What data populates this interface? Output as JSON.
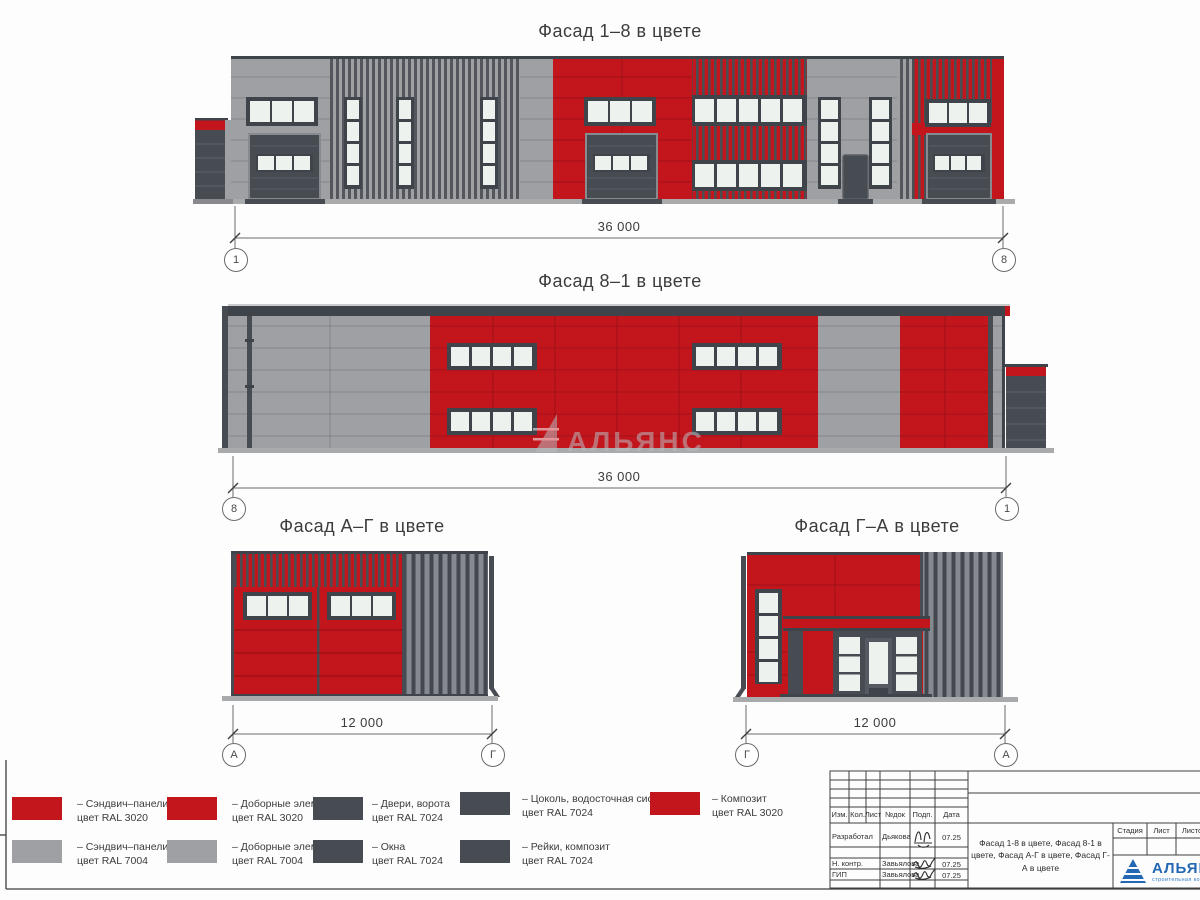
{
  "sheet": {
    "type": "Лист чертежа — фасады здания в цвете"
  },
  "palette": {
    "red_ral3020": "#c3151c",
    "gray_ral7004": "#9ea0a3",
    "dark_ral7024": "#474b52",
    "frame_dark": "#3f444b",
    "glass": "#edf2ee",
    "base_strip": "#a8aaac",
    "logo_blue": "#2468b4",
    "watermark_gray": "#b9bbbe"
  },
  "facades": [
    {
      "title": "Фасад 1–8 в цвете",
      "dimension": "36 000",
      "axis_left": "1",
      "axis_right": "8"
    },
    {
      "title": "Фасад 8–1 в цвете",
      "dimension": "36 000",
      "axis_left": "8",
      "axis_right": "1"
    },
    {
      "title": "Фасад А–Г в цвете",
      "dimension": "12 000",
      "axis_left": "А",
      "axis_right": "Г"
    },
    {
      "title": "Фасад Г–А в цвете",
      "dimension": "12 000",
      "axis_left": "Г",
      "axis_right": "А"
    }
  ],
  "watermark": {
    "text": "АЛЬЯНС"
  },
  "legend": {
    "items": [
      {
        "color": "#c3151c",
        "line1": "– Сэндвич–панели",
        "line2": "цвет RAL 3020"
      },
      {
        "color": "#9ea0a3",
        "line1": "– Сэндвич–панели",
        "line2": "цвет RAL 7004"
      },
      {
        "color": "#c3151c",
        "line1": "– Доборные элементы",
        "line2": "цвет RAL 3020"
      },
      {
        "color": "#9ea0a3",
        "line1": "– Доборные элементы",
        "line2": "цвет RAL 7004"
      },
      {
        "color": "#474b52",
        "line1": "– Двери, ворота",
        "line2": "цвет RAL 7024"
      },
      {
        "color": "#474b52",
        "line1": "– Окна",
        "line2": "цвет RAL 7024"
      },
      {
        "color": "#474b52",
        "line1": "– Цоколь, водосточная система",
        "line2": "цвет RAL 7024"
      },
      {
        "color": "#474b52",
        "line1": "– Рейки, композит",
        "line2": "цвет RAL 7024"
      },
      {
        "color": "#c3151c",
        "line1": "– Композит",
        "line2": "цвет RAL 3020"
      }
    ]
  },
  "title_block": {
    "columns": [
      "Изм.",
      "Кол.",
      "Лист",
      "№док",
      "Подп.",
      "Дата"
    ],
    "rows": [
      {
        "role": "Разработал",
        "name": "Дьякова",
        "date": "07.25"
      },
      {
        "role": "Н. контр.",
        "name": "Завьялова",
        "date": "07.25"
      },
      {
        "role": "ГИП",
        "name": "Завьялова",
        "date": "07.25"
      }
    ],
    "description": "Фасад 1-8 в цвете, Фасад 8-1 в цвете, Фасад А-Г в цвете, Фасад Г-А в цвете",
    "stage_columns": [
      "Стадия",
      "Лист",
      "Листов"
    ],
    "logo": {
      "name": "АЛЬЯНС",
      "subtitle": "строительная компания"
    }
  }
}
